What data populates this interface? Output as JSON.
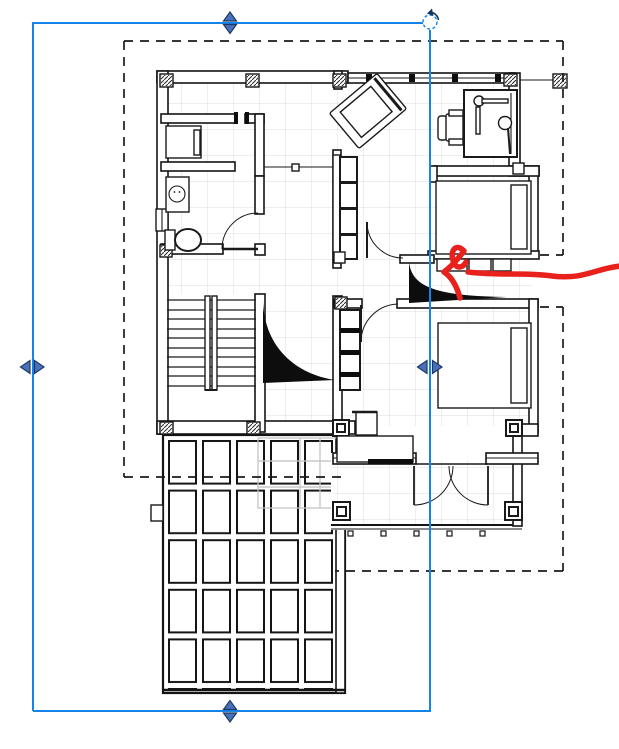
{
  "view": {
    "type": "cad-floor-plan-view",
    "description": "Residential upper-floor plan with stair, two bedrooms, bathroom, balcony and pergola terrace; a view crop region is selected and a red freehand arrow annotation points at the wall between the bedrooms"
  },
  "selection": {
    "element": "crop-region",
    "state": "selected",
    "bounds": {
      "x": 33,
      "y": 23,
      "width": 397,
      "height": 688
    },
    "handles": [
      {
        "name": "top-center-stretch",
        "x": 230,
        "y": 23,
        "orientation": "vertical"
      },
      {
        "name": "bottom-center-stretch",
        "x": 230,
        "y": 711,
        "orientation": "vertical"
      },
      {
        "name": "left-middle-stretch",
        "x": 33,
        "y": 367,
        "orientation": "horizontal"
      },
      {
        "name": "right-middle-stretch",
        "x": 430,
        "y": 367,
        "orientation": "horizontal"
      }
    ],
    "rotation_control": {
      "present": true,
      "x": 430,
      "y": 22
    }
  },
  "annotation_crop": {
    "style": "dashed",
    "segments": [
      {
        "from": [
          124,
          41
        ],
        "to": [
          563,
          41
        ]
      },
      {
        "from": [
          124,
          41
        ],
        "to": [
          124,
          477
        ]
      },
      {
        "from": [
          124,
          477
        ],
        "to": [
          345,
          477
        ]
      },
      {
        "from": [
          563,
          41
        ],
        "to": [
          563,
          255
        ]
      },
      {
        "from": [
          540,
          255
        ],
        "to": [
          563,
          255
        ]
      },
      {
        "from": [
          540,
          307
        ],
        "to": [
          563,
          307
        ]
      },
      {
        "from": [
          563,
          307
        ],
        "to": [
          563,
          571
        ]
      },
      {
        "from": [
          335,
          571
        ],
        "to": [
          563,
          571
        ]
      }
    ]
  },
  "annotation": {
    "type": "freehand-arrow",
    "color": "#e8211d",
    "points_at": "door/wall between bedroom-1 and bedroom-2"
  },
  "plan": {
    "rooms": [
      "bathroom-vanity",
      "bathroom-wc",
      "living-hall",
      "study-corner",
      "bedroom-1",
      "bedroom-2",
      "stairwell",
      "balcony",
      "pergola-terrace"
    ],
    "furniture": [
      "vanity-counter",
      "washing-machine",
      "toilet",
      "sofa-4-seat",
      "tilted-lounge-chair",
      "study-desk",
      "desk-lamp",
      "desk-chair",
      "double-bed-1",
      "double-bed-2",
      "shelf-wardrobe",
      "nightstand",
      "writing-desk",
      "window-bench"
    ],
    "doors": [
      "wc-swing-door",
      "hall-swing-door",
      "bedroom2-swing-door",
      "balcony-double-french-door"
    ],
    "stairs": {
      "treads": 10,
      "center_rail": true,
      "cut_marks": 2
    },
    "terrace_grid": {
      "columns": 5,
      "rows": 5
    }
  },
  "colors": {
    "selection_blue": "#1584e8",
    "handle_fill": "#4a70ba",
    "handle_stroke": "#1f3864",
    "annotation_red": "#e8211d",
    "dash_black": "#1a1a1a",
    "wall_black": "#141414",
    "floor_grid_gray": "#dcdcdc",
    "halftone_gray": "#c4c4c4"
  }
}
